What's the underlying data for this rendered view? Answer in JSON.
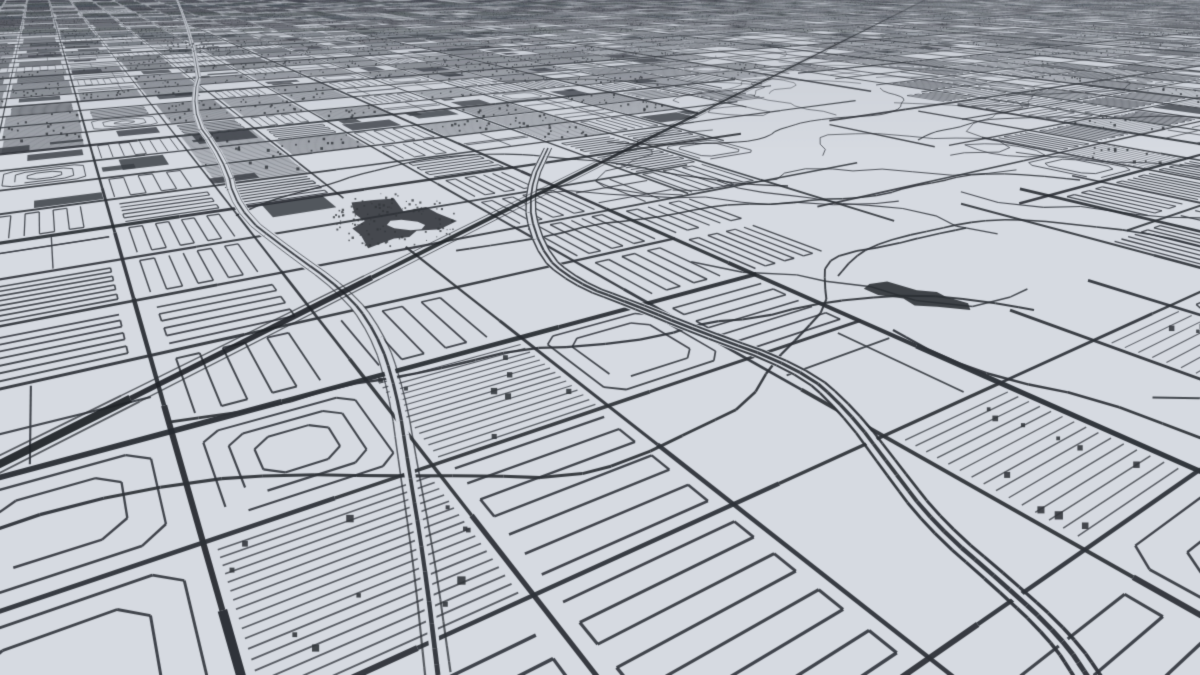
{
  "scene": {
    "type": "map_render",
    "style": "monochrome-3d-aerial-city"
  },
  "canvas": {
    "width": 1200,
    "height": 675
  },
  "camera": {
    "focal": 780,
    "cx": 600,
    "cy": 337.5,
    "height": 260,
    "pitch_deg": 26,
    "yaw_deg": 33,
    "near": 40
  },
  "palette": {
    "background": "#d6dae1",
    "minor_road": "#383c43",
    "arterial_road": "#2e3238",
    "major_road": "#262a30",
    "highway": "#1f2328",
    "building_fill": "#3a3e45",
    "park_fill": "#2f3338",
    "water_fill": "#2b2f34",
    "speckle": "#31353a",
    "haze": "110,116,126"
  },
  "grid": {
    "arterial_spacing": 120,
    "major_every": 4,
    "seed": 20240612,
    "serp_break_prob": 0.22,
    "hills_arterial_skip": 0.72
  },
  "zones": {
    "hills_ellipse": {
      "cx": 940,
      "cy": 255,
      "a": 285,
      "b": 132,
      "rot_deg": 37
    },
    "golf_ellipse": {
      "cx": 520,
      "cy": 258,
      "a": 80,
      "b": 40,
      "rot_deg": 22
    },
    "industrial_band": {
      "x_max": 570,
      "y_max": 252
    },
    "industrial_top": {
      "x_max": 760,
      "y_max": 115
    },
    "industrial_left": {
      "x_max": 175,
      "y_max": 510
    },
    "industrial_foreground": {
      "cx": 220,
      "cy": 612,
      "r": 170
    }
  },
  "features": {
    "highway": {
      "p0": [
        -40,
        484
      ],
      "p1": [
        935,
        -5
      ],
      "width": 4.2,
      "extend": [
        -0.3,
        1.45
      ],
      "frontage_offset": 9,
      "frontage_width": 0.95
    },
    "river": {
      "screen_points": [
        [
          172,
          -12
        ],
        [
          203,
          62
        ],
        [
          189,
          112
        ],
        [
          226,
          162
        ],
        [
          236,
          210
        ],
        [
          290,
          252
        ],
        [
          344,
          290
        ],
        [
          377,
          332
        ],
        [
          397,
          392
        ],
        [
          409,
          470
        ],
        [
          424,
          560
        ],
        [
          438,
          675
        ]
      ],
      "width": 2.0,
      "clear_width": 13,
      "side_offset": 5,
      "side_width": 0.9
    },
    "creek": {
      "screen_points": [
        [
          548,
          148
        ],
        [
          527,
          192
        ],
        [
          538,
          250
        ],
        [
          575,
          283
        ],
        [
          632,
          304
        ],
        [
          700,
          332
        ],
        [
          800,
          368
        ],
        [
          848,
          410
        ],
        [
          893,
          470
        ],
        [
          935,
          525
        ],
        [
          1005,
          585
        ],
        [
          1062,
          638
        ],
        [
          1090,
          680
        ]
      ],
      "widths": [
        1.5,
        2.1,
        1.5
      ],
      "offsets": [
        -5.5,
        0,
        5.5
      ],
      "clear_width": 12
    },
    "park_blob": {
      "cx": 394,
      "cy": 221,
      "rx": 46,
      "ry": 20,
      "island": {
        "cx": 406,
        "cy": 225,
        "rx": 16,
        "ry": 6
      },
      "speckle_count": 130,
      "speckle_rx": 64,
      "speckle_ry": 28
    },
    "lake_blob": {
      "cx": 916,
      "cy": 296,
      "rx": 46,
      "ry": 9,
      "rot_deg": 8
    },
    "top_left_cluster": {
      "cx": 192,
      "cy": 48,
      "rx": 27,
      "ry": 10,
      "count": 46
    },
    "hill_road_seeds": [
      [
        742,
        98
      ],
      [
        788,
        186
      ],
      [
        838,
        276
      ],
      [
        918,
        140
      ],
      [
        966,
        228
      ],
      [
        1034,
        310
      ],
      [
        880,
        88
      ],
      [
        1006,
        96
      ],
      [
        893,
        330
      ],
      [
        1080,
        180
      ]
    ]
  }
}
